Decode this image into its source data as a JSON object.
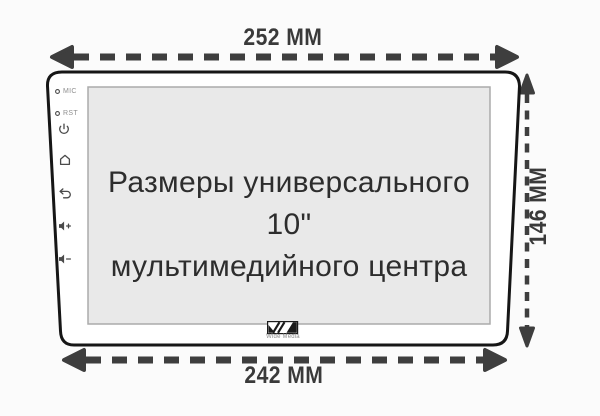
{
  "diagram": {
    "kind": "product-dimension-drawing",
    "title_line1": "Размеры универсального 10\"",
    "title_line2": "мультимедийного центра",
    "dimensions": {
      "top_width": "252 ММ",
      "bottom_width": "242 ММ",
      "height": "146 ММ"
    },
    "device": {
      "mic_label": "MIC",
      "rst_label": "RST",
      "brand": "Wide Media",
      "side_icons": [
        "power",
        "home",
        "back",
        "volume-up",
        "volume-down"
      ]
    },
    "colors": {
      "background": "#fbfbfb",
      "dimension_lines": "#3e3e3e",
      "dimension_text": "#3a3a3a",
      "device_outline": "#161616",
      "screen_fill": "#e9e9e9",
      "screen_border": "#ababab",
      "title_text": "#2d2d2d",
      "icon_stroke": "#4a4a4a"
    }
  }
}
